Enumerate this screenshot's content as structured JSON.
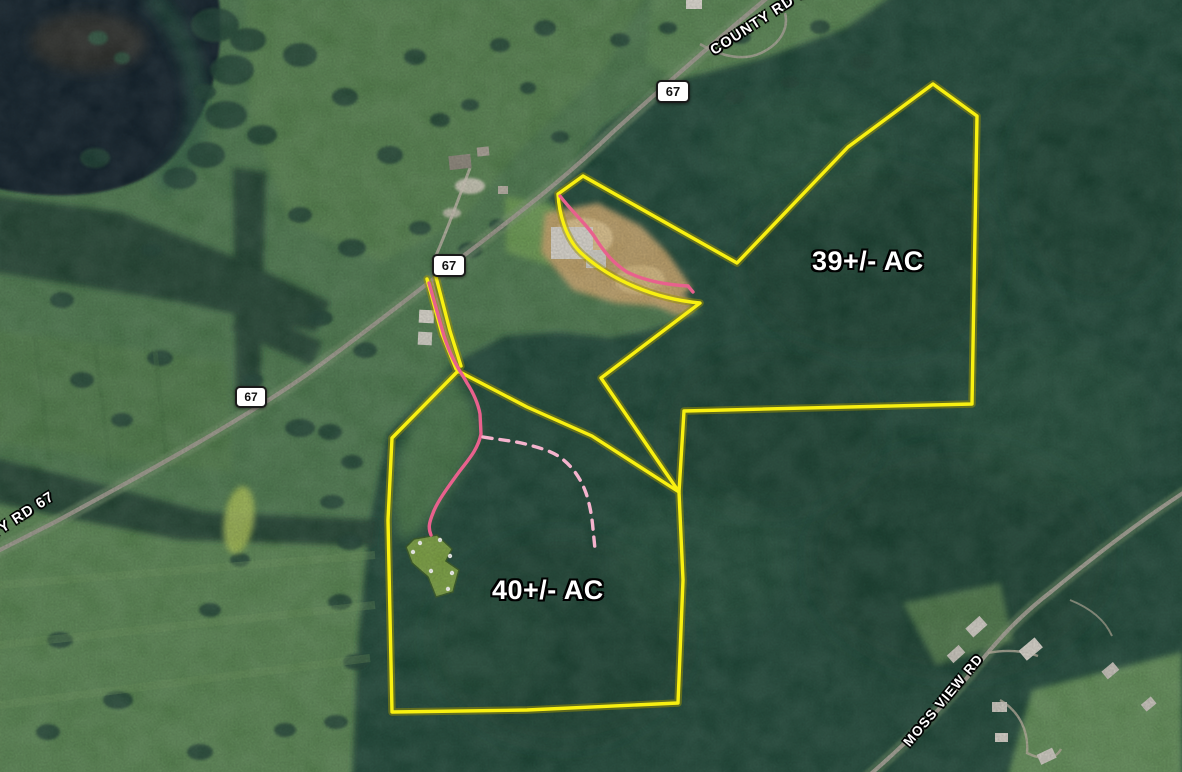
{
  "map": {
    "type": "aerial-property-map",
    "parcels": [
      {
        "id": "north-parcel",
        "acreage_label": "39+/- AC"
      },
      {
        "id": "south-parcel",
        "acreage_label": "40+/- AC"
      }
    ],
    "roads": {
      "county_rd_top_label": "COUNTY RD 67",
      "county_rd_left_label": "COUNTY RD 67",
      "moss_view_label": "MOSS VIEW RD"
    },
    "shields": [
      {
        "label": "67"
      },
      {
        "label": "67"
      },
      {
        "label": "67"
      }
    ],
    "colors": {
      "parcel_boundary": "#f8f011",
      "trail_solid": "#e8618d",
      "trail_dashed": "#f5b3cd",
      "shield_background": "#ffffff",
      "shield_border": "#1a1a1a",
      "label_text": "#ffffff",
      "forest_green": "#1f4434",
      "field_green": "#4a764b",
      "water_dark": "#0c1e27"
    }
  }
}
